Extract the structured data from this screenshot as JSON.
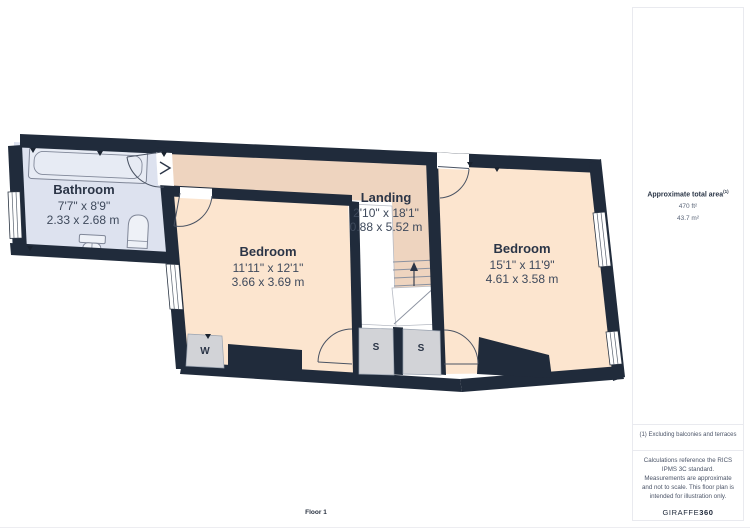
{
  "floor_plan": {
    "floor_label": "Floor 1",
    "rooms": [
      {
        "name": "Bathroom",
        "dims_imperial": "7'7\" x 8'9\"",
        "dims_metric": "2.33 x 2.68 m"
      },
      {
        "name": "Bedroom",
        "dims_imperial": "11'11\" x 12'1\"",
        "dims_metric": "3.66 x 3.69 m"
      },
      {
        "name": "Landing",
        "dims_imperial": "2'10\" x 18'1\"",
        "dims_metric": "0.88 x 5.52 m"
      },
      {
        "name": "Bedroom",
        "dims_imperial": "15'1\" x 11'9\"",
        "dims_metric": "4.61 x 3.58 m"
      }
    ],
    "closets": [
      {
        "label": "W"
      },
      {
        "label": "S"
      },
      {
        "label": "S"
      }
    ],
    "colors": {
      "wall": "#202b3b",
      "bathroom_fill": "#dde2ef",
      "bedroom_fill": "#fce5cf",
      "landing_fill": "#eed4bf",
      "closet_fill": "#d2d3d7",
      "text": "#2b3547"
    }
  },
  "sidebar": {
    "total_area": {
      "title": "Approximate total area",
      "superscript": "(1)",
      "value_imperial": "470 ft²",
      "value_metric": "43.7 m²"
    },
    "footnote": "(1) Excluding balconies and terraces",
    "disclaimer": "Calculations reference the RICS IPMS 3C standard. Measurements are approximate and not to scale. This floor plan is intended for illustration only.",
    "brand": {
      "name_regular": "GIRAFFE",
      "name_bold": "360"
    }
  }
}
